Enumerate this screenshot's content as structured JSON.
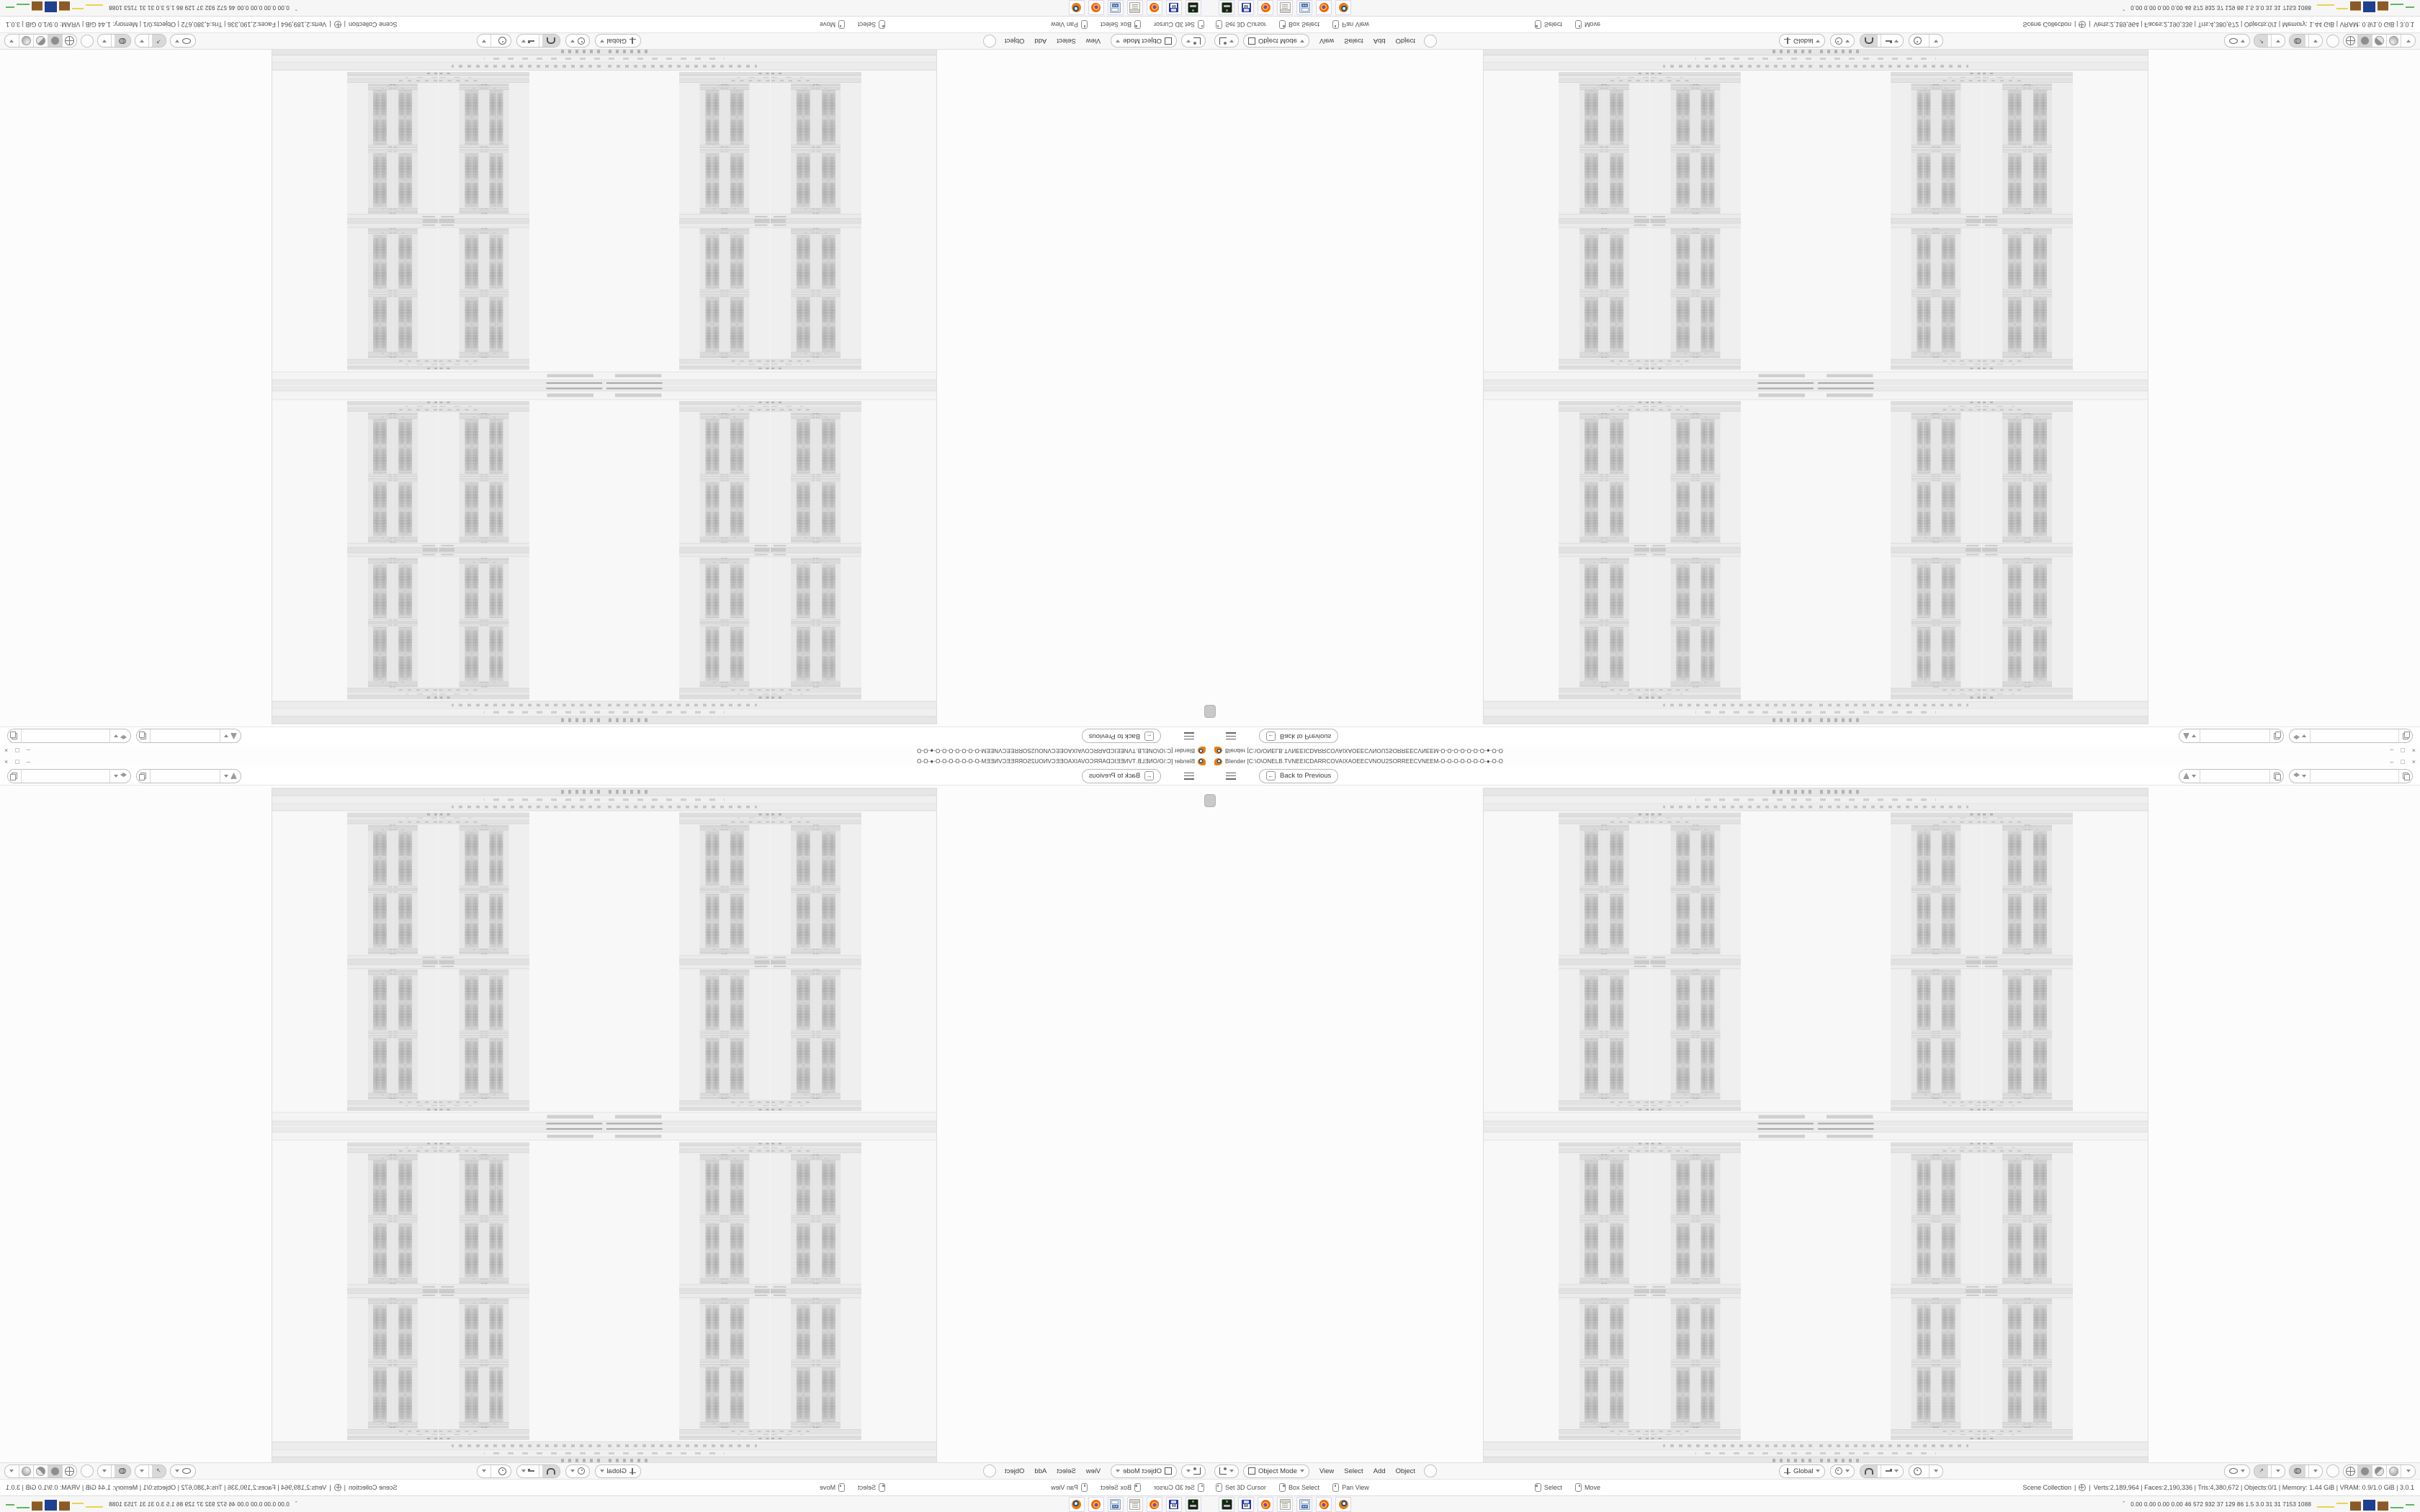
{
  "window": {
    "app_icon": "blender-logo",
    "title": "Blender [C:\\O\\ONELB.TVNEEICDARRCOVAIXAOEECVNOU2SORREECVNEEM-O-O-O-O-O-O-O-●-O-O",
    "minimize_glyph": "–",
    "restore_glyph": "□",
    "close_glyph": "×"
  },
  "topbar": {
    "menu_icon": "hamburger",
    "back_button": {
      "icon": "arrow-left",
      "arrow_glyph": "←",
      "label": "Back to Previous"
    },
    "scene_selector": {
      "icon": "scene-icon",
      "value": "",
      "new_icon": "duplicate-icon"
    },
    "view_layer_selector": {
      "icon": "layers-icon",
      "value": "",
      "new_icon": "duplicate-icon"
    }
  },
  "viewport": {
    "toolbar_tab_icon": "collapsed-toolbar-tab",
    "content": "recursive-screenshot-image"
  },
  "header": {
    "editor_icon": "editor-3d-viewport",
    "mode": {
      "icon": "object-mode-icon",
      "label": "Object Mode"
    },
    "menus": [
      "View",
      "Select",
      "Add",
      "Object"
    ],
    "orientation": {
      "icon": "axes-icon",
      "label": "Global"
    },
    "pivot_icon": "pivot-point-icon",
    "snap_icon": "magnet-icon",
    "snap_target_icon": "snap-increment-icon",
    "proportional_icon": "proportional-editing-icon",
    "visibility_icon": "object-visibility-icon",
    "gizmos_icon": "gizmo-icon",
    "gizmo_glyph": "↗",
    "overlays_icon": "overlays-icon",
    "xray_icon": "xray-toggle",
    "shading_modes": [
      "wireframe",
      "solid",
      "material-preview",
      "rendered"
    ],
    "active_shading": "solid"
  },
  "status": {
    "hints": [
      {
        "icon": "mouse-left",
        "label": "Set 3D Cursor"
      },
      {
        "icon": "mouse-right",
        "label": "Box Select"
      },
      {
        "icon": "mouse-middle",
        "label": "Pan View"
      },
      {
        "icon": "mouse-left",
        "label": "Select"
      },
      {
        "icon": "mouse-right",
        "label": "Move"
      }
    ],
    "collection": "Scene Collection",
    "sep": "|",
    "object_icon": "empty-axes-icon",
    "stats": "Verts:2,189,964 | Faces:2,190,336 | Tris:4,380,672 | Objects:0/1 | Memory: 1.44 GiB | VRAM: 0.9/1.0 GiB | 3.0.1"
  },
  "taskbar": {
    "apps": [
      "console-app",
      "setup-win64",
      "firefox",
      "notepad",
      "calculator",
      "firefox",
      "blender"
    ],
    "floppy_label": "64",
    "tray_chevron": "ˆ",
    "tray_stats": "0.00 0.00 0.00 0.00   46   572   932   37   129   86   1.5   3.0   31   31   7153 1088",
    "graph_colors": {
      "yellow": "#e8d44d",
      "brown": "#8a5a28",
      "blue": "#1f3f8f",
      "green": "#5cb85c"
    }
  },
  "composition": {
    "note": "single desktop screenshot mirrored into four quadrants",
    "quadrants": [
      "mirrored-both",
      "mirrored-vertical",
      "mirrored-horizontal",
      "normal"
    ]
  }
}
